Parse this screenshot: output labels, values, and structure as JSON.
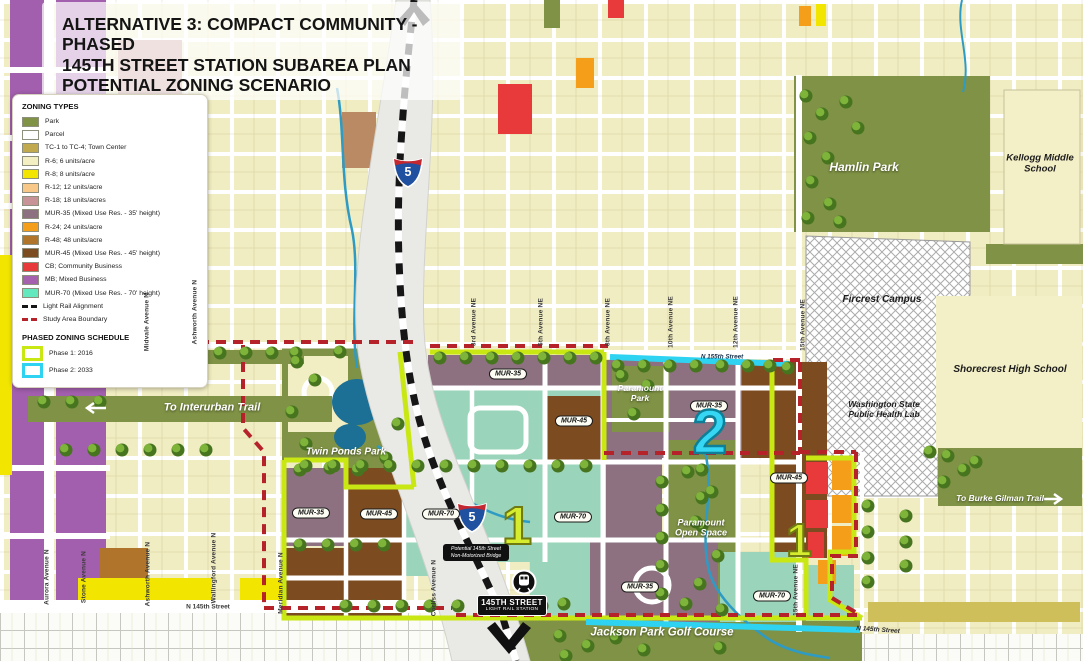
{
  "title": {
    "line1": "ALTERNATIVE 3: COMPACT COMMUNITY - PHASED",
    "line2": "145TH STREET STATION SUBAREA PLAN",
    "line3": "POTENTIAL ZONING SCENARIO"
  },
  "legend": {
    "zoning_title": "ZONING TYPES",
    "items": [
      {
        "label": "Park",
        "color": "#7f9245"
      },
      {
        "label": "Parcel",
        "color": "#ffffff"
      },
      {
        "label": "TC-1 to TC-4; Town Center",
        "color": "#c0a94e"
      },
      {
        "label": "R-6; 6 units/acre",
        "color": "#f3efc3"
      },
      {
        "label": "R-8; 8 units/acre",
        "color": "#f2e600"
      },
      {
        "label": "R-12; 12 units/acre",
        "color": "#f8c888"
      },
      {
        "label": "R-18; 18 units/acres",
        "color": "#c79397"
      },
      {
        "label": "MUR-35 (Mixed Use Res. - 35' height)",
        "color": "#8d7180"
      },
      {
        "label": "R-24; 24 units/acre",
        "color": "#f49e19"
      },
      {
        "label": "R-48; 48 units/acre",
        "color": "#b0742b"
      },
      {
        "label": "MUR-45 (Mixed Use Res. - 45' height)",
        "color": "#7c4b20"
      },
      {
        "label": "CB; Community Business",
        "color": "#e8393b"
      },
      {
        "label": "MB; Mixed Business",
        "color": "#a560ae"
      },
      {
        "label": "MUR-70 (Mixed Use Res. - 70' height)",
        "color": "#63e9bd"
      },
      {
        "label": "Light Rail Alignment",
        "color": "#161616"
      },
      {
        "label": "Study Area Boundary",
        "color": "#b5222a"
      }
    ],
    "phased_title": "PHASED ZONING SCHEDULE",
    "phases": [
      {
        "label": "Phase 1: 2016",
        "color": "#c9e713"
      },
      {
        "label": "Phase 2: 2033",
        "color": "#2fd3f2"
      }
    ]
  },
  "map": {
    "streets_vertical": [
      "Aurora Avenue N",
      "Stone Avenue N",
      "Ashworth Avenue N",
      "Wallingford Avenue N",
      "Meridian Avenue N",
      "Corliss Avenue N",
      "Midvale Avenue N",
      "Ashworth Avenue N",
      "3rd Avenue NE",
      "5th Avenue NE",
      "8th Avenue NE",
      "10th Avenue NE",
      "12th Avenue NE",
      "15th Avenue NE",
      "15th Avenue NE"
    ],
    "streets_horizontal": [
      "N 145th Street",
      "N 155th Street",
      "N 145th Street"
    ],
    "parks": [
      "Hamlin Park",
      "Twin Ponds Park",
      "Paramount Park",
      "Paramount Open Space",
      "Jackson Park Golf Course"
    ],
    "facilities": [
      "Kellogg Middle School",
      "Shorecrest High School",
      "Fircrest Campus",
      "Washington State Public Health Lab"
    ],
    "trails": [
      "To Interurban Trail",
      "To Burke Gilman Trail"
    ],
    "zone_badges": [
      "MUR-35",
      "MUR-45",
      "MUR-35",
      "MUR-45",
      "MUR-35",
      "MUR-45",
      "MUR-70",
      "MUR-70",
      "MUR-35",
      "MUR-70"
    ],
    "phase_markers": [
      "1",
      "2",
      "1"
    ],
    "station": {
      "line1": "145TH STREET",
      "line2": "LIGHT RAIL STATION"
    },
    "bridge_note": {
      "line1": "Potential 145th Street",
      "line2": "Non-Motorized Bridge"
    },
    "interstate_shield": "5"
  }
}
